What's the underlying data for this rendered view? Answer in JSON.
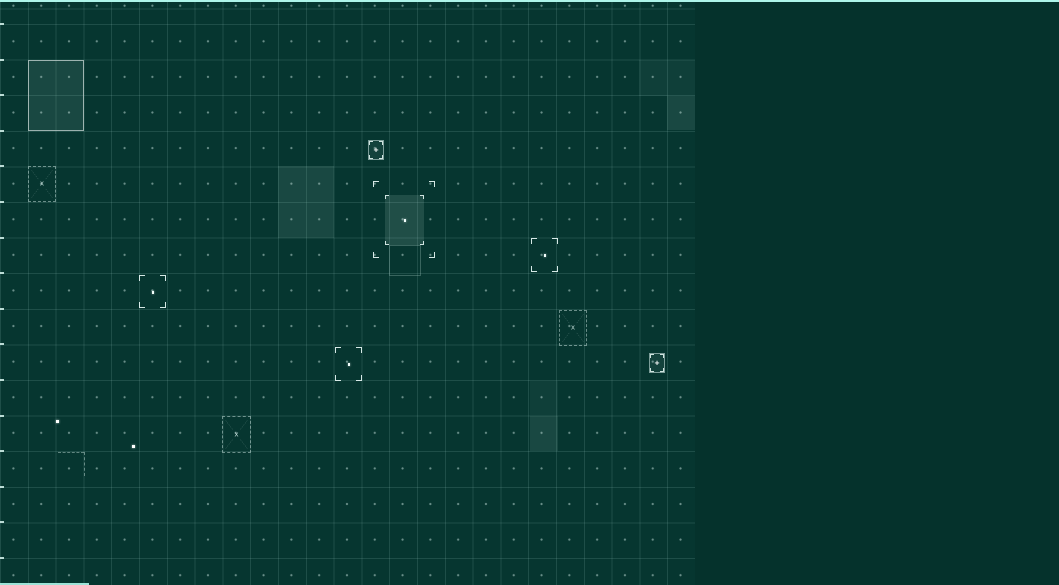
{
  "app": {
    "name": "tactical-grid-view"
  },
  "colors": {
    "background": "#063630",
    "panel": "#05322c",
    "grid_line": "#a8d6cf",
    "accent_cyan": "#aef5ea",
    "marker_white": "#f2fffc",
    "zone_tint": "#c8e8e3"
  },
  "glyphs": {
    "plus": "+",
    "cross": "x"
  },
  "grid": {
    "columns": 25,
    "col_width": 27.8,
    "row_height": 35.6,
    "row_offset": 24,
    "field_width": 695,
    "field_height": 585,
    "tick_count": 16
  },
  "objects": [
    {
      "type": "zone",
      "name": "selected-zone",
      "x": 28,
      "y": 60,
      "w": 56,
      "h": 71,
      "shade": "medium",
      "border": true
    },
    {
      "type": "hazard",
      "name": "hazard-marker",
      "x": 28,
      "y": 166,
      "w": 28,
      "h": 36
    },
    {
      "type": "zone",
      "name": "highlight-zone",
      "x": 278,
      "y": 166,
      "w": 56,
      "h": 72,
      "shade": "medium"
    },
    {
      "type": "unit",
      "name": "unit-marker",
      "x": 368,
      "y": 140,
      "w": 16,
      "h": 20
    },
    {
      "type": "bracket",
      "name": "selection-frame",
      "x": 373,
      "y": 181,
      "w": 62,
      "h": 77,
      "dot": false
    },
    {
      "type": "zone",
      "name": "active-zone",
      "x": 385,
      "y": 195,
      "w": 39,
      "h": 50,
      "shade": "bright",
      "ticks": true,
      "dot": true
    },
    {
      "type": "outline",
      "name": "ghost-outline",
      "x": 389,
      "y": 245,
      "w": 32,
      "h": 31
    },
    {
      "type": "bracket",
      "name": "selection-marker",
      "x": 531,
      "y": 238,
      "w": 27,
      "h": 34,
      "dot": true
    },
    {
      "type": "bracket",
      "name": "selection-marker",
      "x": 139,
      "y": 275,
      "w": 27,
      "h": 33,
      "dot": true
    },
    {
      "type": "hazard",
      "name": "hazard-marker",
      "x": 559,
      "y": 310,
      "w": 28,
      "h": 36
    },
    {
      "type": "bracket",
      "name": "selection-marker",
      "x": 335,
      "y": 347,
      "w": 27,
      "h": 34,
      "dot": true
    },
    {
      "type": "unit",
      "name": "unit-marker",
      "x": 649,
      "y": 353,
      "w": 16,
      "h": 20
    },
    {
      "type": "zone",
      "name": "highlight-zone",
      "x": 530,
      "y": 381,
      "w": 28,
      "h": 35,
      "shade": "subtle"
    },
    {
      "type": "zone",
      "name": "highlight-zone",
      "x": 530,
      "y": 416,
      "w": 28,
      "h": 35,
      "shade": "medium"
    },
    {
      "type": "hazard",
      "name": "hazard-marker",
      "x": 222,
      "y": 416,
      "w": 29,
      "h": 37
    },
    {
      "type": "dot",
      "name": "waypoint-dot",
      "x": 56,
      "y": 420,
      "w": 3,
      "h": 3
    },
    {
      "type": "dot",
      "name": "waypoint-dot",
      "x": 132,
      "y": 445,
      "w": 3,
      "h": 3
    },
    {
      "type": "dashline",
      "name": "construction-line",
      "x": 58,
      "y": 452,
      "w": 26,
      "h": 0
    },
    {
      "type": "dashline",
      "name": "construction-line",
      "x": 84,
      "y": 452,
      "w": 0,
      "h": 24
    },
    {
      "type": "zone",
      "name": "highlight-zone",
      "x": 639,
      "y": 60,
      "w": 56,
      "h": 36,
      "shade": "subtle"
    },
    {
      "type": "zone",
      "name": "highlight-zone",
      "x": 667,
      "y": 96,
      "w": 28,
      "h": 34,
      "shade": "medium"
    },
    {
      "type": "accent",
      "name": "scan-line",
      "x": 0,
      "y": 583,
      "w": 89,
      "h": 2
    }
  ]
}
